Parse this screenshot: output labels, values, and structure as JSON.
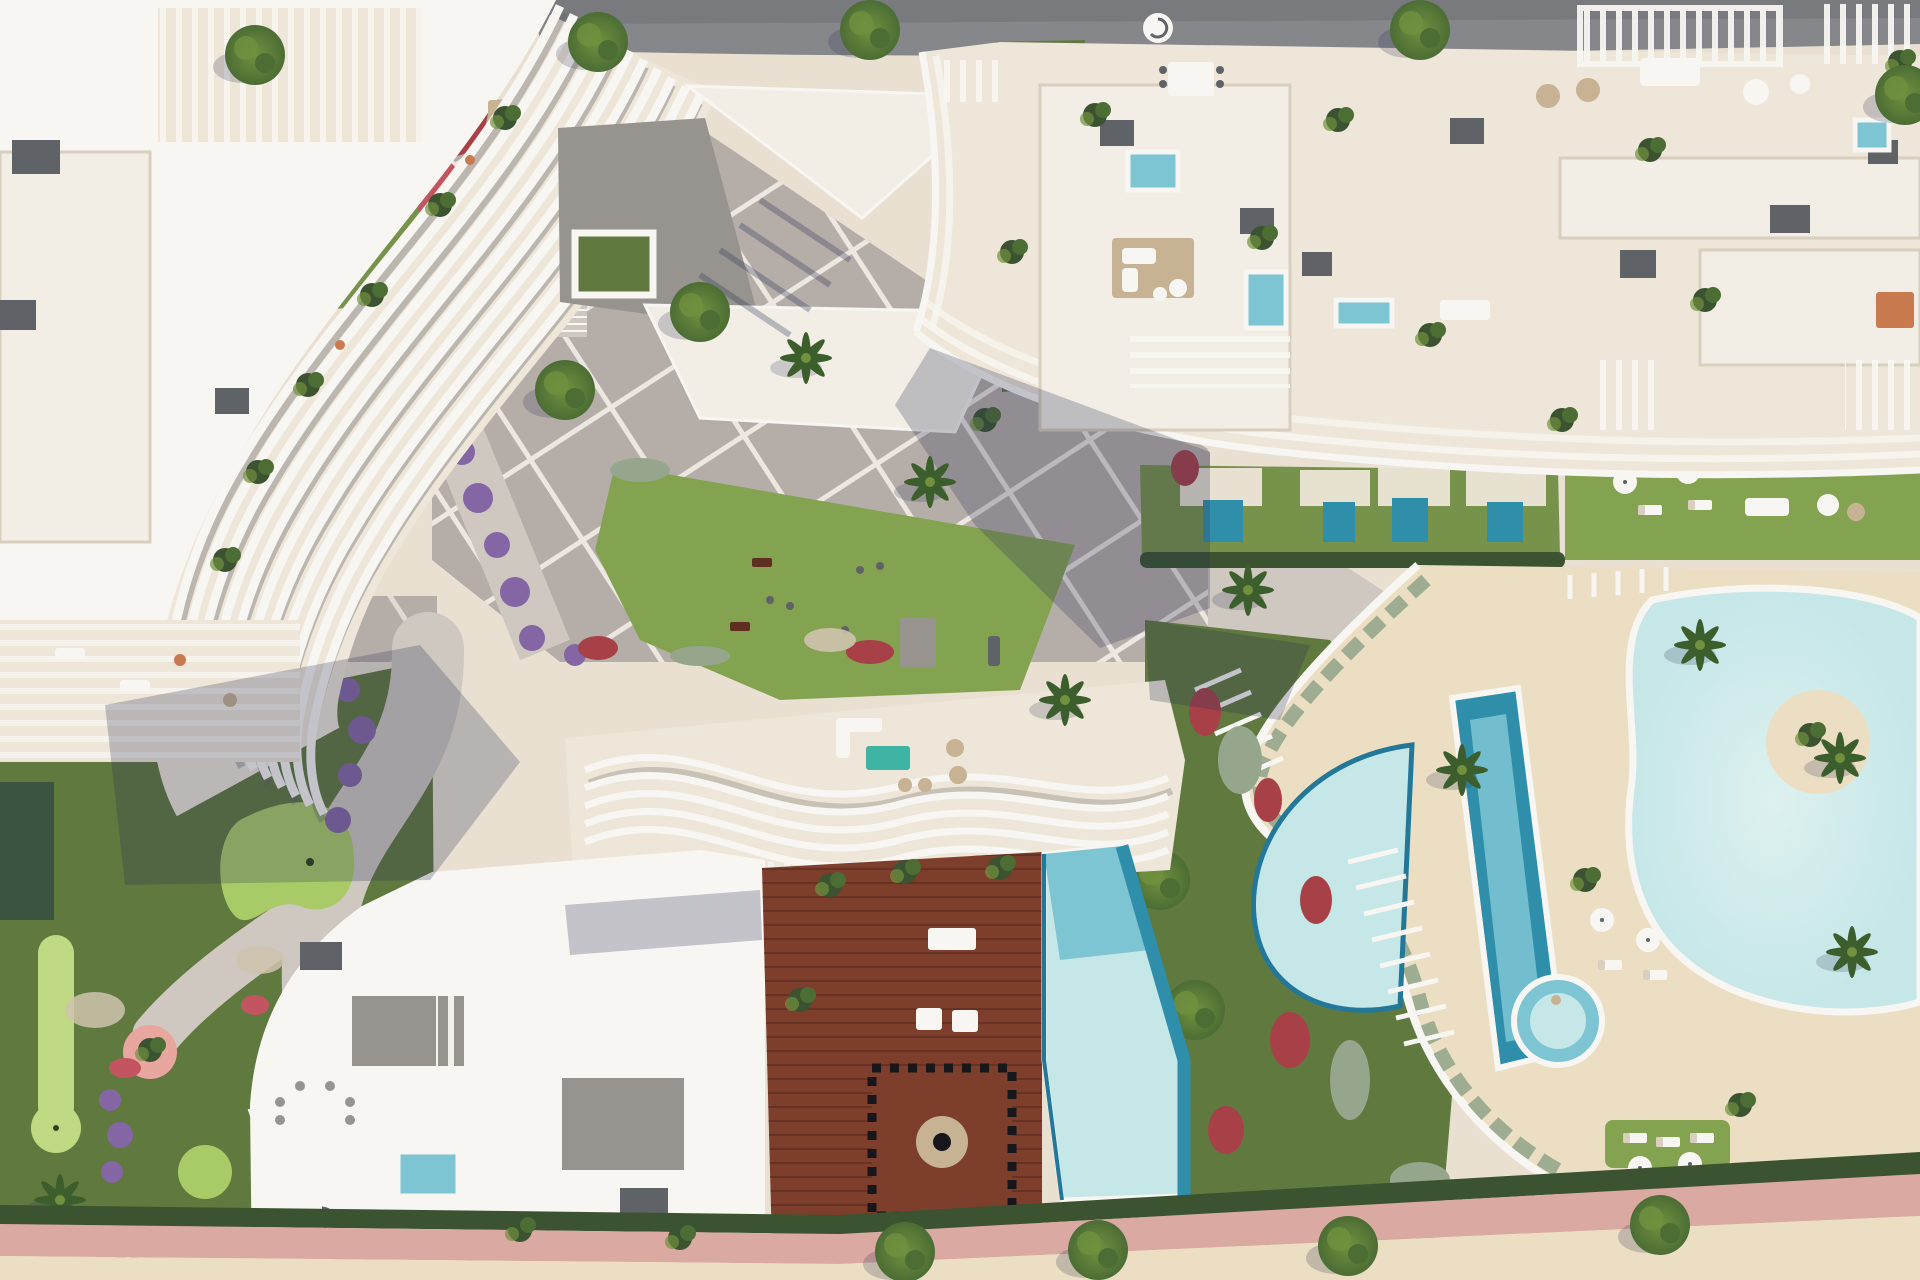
{
  "scene": {
    "title": "Aerial top-down architectural rendering of a white luxury apartment resort complex",
    "type": "3d-render-site-plan",
    "regions": {
      "road": "Asphalt road along the top edge",
      "topLeftBuilding": "Curved white apartment building with wavy slatted fin facade and rooftop terraces",
      "topGarden": "Private lawn garden with plunge pool and red flower beds",
      "pavilion": "Entrance pavilion with angular white canopies and pergola",
      "rightBuilding": "Large white-cream apartment block with rooftop terraces, pergolas and plunge pools",
      "plaza": "Central diagonal paved plaza with white grid joints, trees and stairs",
      "gymLawn": "Outdoor gym on communal lawn",
      "privateLawns": "Ground-floor private lawns with plunge pools",
      "poolArea": "Communal lagoon pool, lap pool, kids pool and jacuzzi on sand-coloured deck",
      "island": "Planted sand island inside lagoon pool",
      "bottomBuilding": "Apartment building with wavy ribbon roof, timber roof deck and infinity pool",
      "miniGolf": "Putting-green mini golf garden with winding paths",
      "promenade": "Pink beachfront promenade with hedge and sand strip"
    }
  },
  "colors": {
    "sand": "#e9e0d2",
    "sandDeep": "#ecdec2",
    "cream": "#eee6d8",
    "white": "#f8f6f2",
    "roofSlab": "#f2eee6",
    "creamShade": "#d9cfbf",
    "plaza": "#b5ada8",
    "plazaLine": "#f2ede6",
    "pathLight": "#cfc8c0",
    "road": "#86878b",
    "roadDark": "#6e6f74",
    "grayBox": "#5f6367",
    "patio": "#97948f",
    "lawn": "#77924a",
    "lawnBright": "#83a351",
    "lawnDark": "#60793f",
    "putting": "#a9cb67",
    "puttingPale": "#c0da84",
    "hedge": "#3b5330",
    "hedgeGray": "#96a68c",
    "tree": "#4c6d34",
    "treeLight": "#71913f",
    "palm": "#3c5e2c",
    "red": "#a84048",
    "redBright": "#c25560",
    "purple": "#8566a5",
    "flowerMix": "#cfc3ad",
    "poolPale": "#c6e7e8",
    "poolMid": "#7ec5d3",
    "poolDeep": "#2f8fab",
    "poolEdge": "#23789a",
    "wood": "#7d3f2c",
    "woodDark": "#5f2f22",
    "promenade": "#d9a9a2",
    "shadow": "#2c3356",
    "teal": "#3fb3a4",
    "tan": "#c7b394",
    "orange": "#c97a4e",
    "darkGreenBox": "#2f4a2b",
    "pond": "#3a5440",
    "car": "#b03832"
  }
}
